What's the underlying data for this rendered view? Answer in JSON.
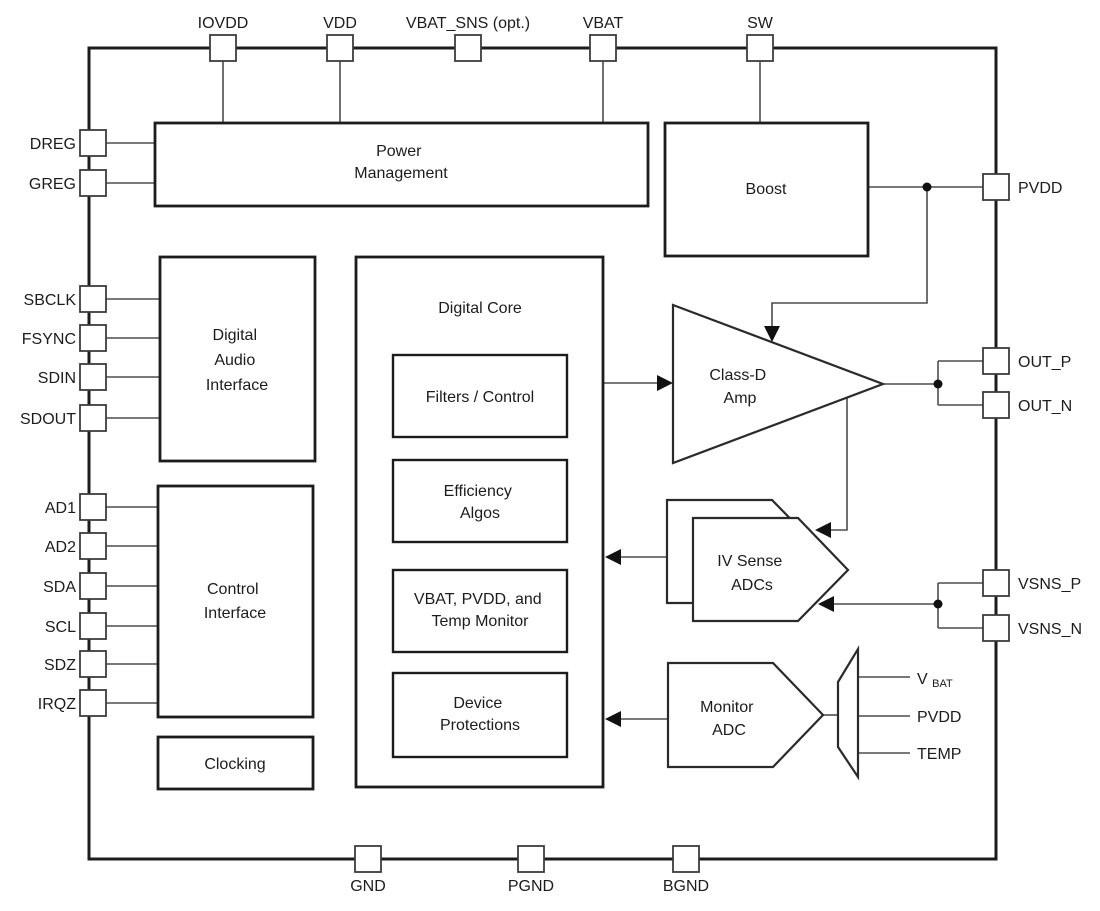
{
  "figure": {
    "type": "functional-block-diagram",
    "colors": {
      "background": "#ffffff",
      "block_line": "#1c1c1c",
      "thin_line": "#4d4d4d",
      "text": "#1c1c1c"
    },
    "pins": {
      "top": {
        "iovdd": "IOVDD",
        "vdd": "VDD",
        "vbat_sns": "VBAT_SNS (opt.)",
        "vbat": "VBAT",
        "sw": "SW"
      },
      "left": {
        "dreg": "DREG",
        "greg": "GREG",
        "sbclk": "SBCLK",
        "fsync": "FSYNC",
        "sdin": "SDIN",
        "sdout": "SDOUT",
        "ad1": "AD1",
        "ad2": "AD2",
        "sda": "SDA",
        "scl": "SCL",
        "sdz": "SDZ",
        "irqz": "IRQZ"
      },
      "right": {
        "pvdd": "PVDD",
        "out_p": "OUT_P",
        "out_n": "OUT_N",
        "vsns_p": "VSNS_P",
        "vsns_n": "VSNS_N"
      },
      "bottom": {
        "gnd": "GND",
        "pgnd": "PGND",
        "bgnd": "BGND"
      }
    },
    "blocks": {
      "power_management": {
        "l1": "Power",
        "l2": "Management"
      },
      "boost": {
        "l1": "Boost"
      },
      "digital_audio_interface": {
        "l1": "Digital",
        "l2": "Audio",
        "l3": "Interface"
      },
      "control_interface": {
        "l1": "Control",
        "l2": "Interface"
      },
      "clocking": {
        "l1": "Clocking"
      },
      "digital_core": {
        "title": "Digital Core"
      },
      "filters_control": {
        "l1": "Filters / Control"
      },
      "efficiency_algos": {
        "l1": "Efficiency",
        "l2": "Algos"
      },
      "vbat_pvdd_temp_monitor": {
        "l1": "VBAT, PVDD, and",
        "l2": "Temp Monitor"
      },
      "device_protections": {
        "l1": "Device",
        "l2": "Protections"
      },
      "class_d_amp": {
        "l1": "Class-D",
        "l2": "Amp"
      },
      "iv_sense_adcs": {
        "l1": "IV Sense",
        "l2": "ADCs"
      },
      "monitor_adc": {
        "l1": "Monitor",
        "l2": "ADC"
      }
    },
    "mux_inputs": {
      "vbat_main": "V",
      "vbat_sub": "BAT",
      "pvdd": "PVDD",
      "temp": "TEMP"
    }
  }
}
